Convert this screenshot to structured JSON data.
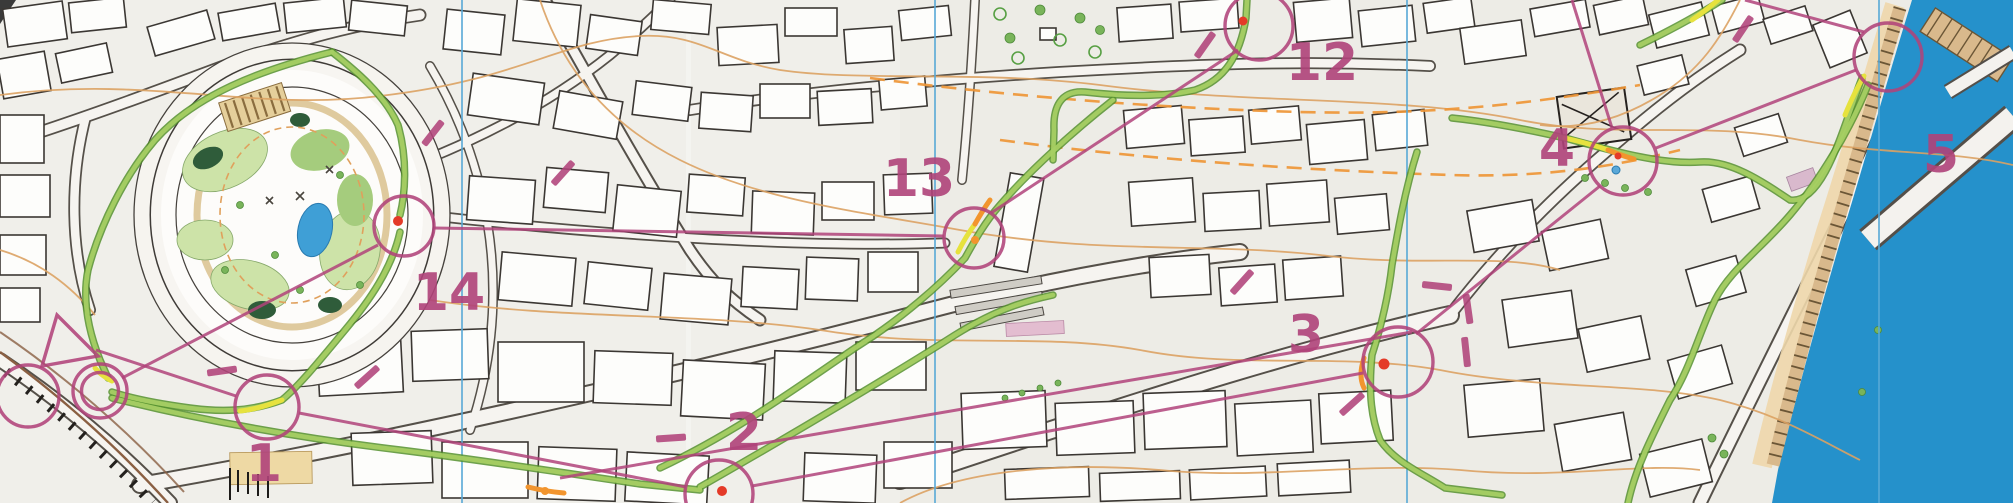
{
  "map": {
    "kind": "orienteering-sprint-course-scan",
    "description": "Scanned city sprint orienteering map with purple course overprint and GPS route colored by speed",
    "course": {
      "overprint_color": "#b0437a",
      "controls": [
        {
          "label": "1",
          "circle_x": 267,
          "circle_y": 407,
          "label_x": 264,
          "label_y": 481
        },
        {
          "label": "2",
          "circle_x": 719,
          "circle_y": 494,
          "label_x": 744,
          "label_y": 450
        },
        {
          "label": "3",
          "circle_x": 1398,
          "circle_y": 362,
          "label_x": 1306,
          "label_y": 352
        },
        {
          "label": "4",
          "circle_x": 1623,
          "circle_y": 161,
          "label_x": 1557,
          "label_y": 166
        },
        {
          "label": "5",
          "circle_x": 1888,
          "circle_y": 57,
          "label_x": 1941,
          "label_y": 172
        },
        {
          "label": "12",
          "circle_x": 1259,
          "circle_y": 26,
          "label_x": 1322,
          "label_y": 80
        },
        {
          "label": "13",
          "circle_x": 974,
          "circle_y": 238,
          "label_x": 919,
          "label_y": 196
        },
        {
          "label": "14",
          "circle_x": 404,
          "circle_y": 226,
          "label_x": 449,
          "label_y": 310
        }
      ],
      "start_triangle": {
        "x": 66,
        "y": 345
      },
      "finish_double_circle": {
        "x": 100,
        "y": 391
      },
      "extra_circle_left_edge": {
        "x": 28,
        "y": 396
      },
      "legs_visible": [
        "start-1",
        "1-2",
        "2-3",
        "3-4",
        "4-5",
        "5-offmap-top",
        "offmap-12",
        "12-13",
        "13-14",
        "14-finish"
      ],
      "forbidden_crossing_bars_count": 12
    },
    "gps_track": {
      "fast_color": "#a6cf63",
      "border_color": "#55912e",
      "slow_colors": {
        "slow": "#e6e23e",
        "slower": "#f2952e",
        "stopped": "#e43a28"
      },
      "stop_marks_at_controls": [
        "14",
        "13",
        "12",
        "3",
        "2",
        "4"
      ]
    },
    "north_lines": {
      "color": "#58a9d7",
      "x_positions": [
        462,
        935,
        1407,
        1879
      ]
    },
    "water": {
      "color": "#2591cb",
      "location": "right-edge-harbor",
      "bridge": true
    },
    "park": {
      "location": "left-oval",
      "pond_color": "#3f9fd6"
    },
    "palette": {
      "paper": "#f1efea",
      "building_outline": "#3b3733",
      "contour_orange": "#dca263",
      "dashed_overprint_orange": "#ee9637",
      "park_green_light": "#cde3a8",
      "park_green_mid": "#a5cc7d",
      "park_green_dark": "#2f5c3a",
      "quay_tan": "#d9b98c"
    }
  }
}
